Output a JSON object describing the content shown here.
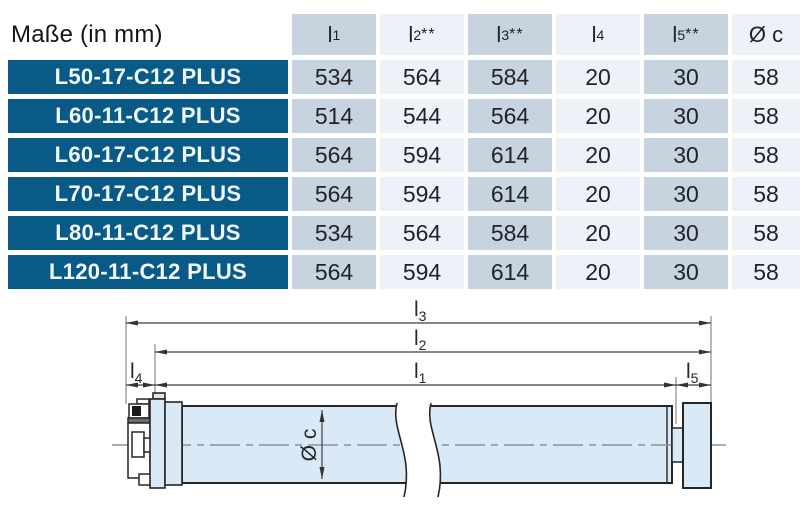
{
  "table": {
    "title": "Maße (in mm)",
    "headers": [
      {
        "base": "l",
        "sub": "1",
        "sup": ""
      },
      {
        "base": "l",
        "sub": "2",
        "sup": "**"
      },
      {
        "base": "l",
        "sub": "3",
        "sup": "**"
      },
      {
        "base": "l",
        "sub": "4",
        "sup": ""
      },
      {
        "base": "l",
        "sub": "5",
        "sup": "**"
      },
      {
        "base": "Ø c",
        "sub": "",
        "sup": ""
      }
    ],
    "rows": [
      {
        "model": "L50-17-C12 PLUS",
        "l1": "534",
        "l2": "564",
        "l3": "584",
        "l4": "20",
        "l5": "30",
        "dc": "58"
      },
      {
        "model": "L60-11-C12 PLUS",
        "l1": "514",
        "l2": "544",
        "l3": "564",
        "l4": "20",
        "l5": "30",
        "dc": "58"
      },
      {
        "model": "L60-17-C12 PLUS",
        "l1": "564",
        "l2": "594",
        "l3": "614",
        "l4": "20",
        "l5": "30",
        "dc": "58"
      },
      {
        "model": "L70-17-C12 PLUS",
        "l1": "564",
        "l2": "594",
        "l3": "614",
        "l4": "20",
        "l5": "30",
        "dc": "58"
      },
      {
        "model": "L80-11-C12 PLUS",
        "l1": "534",
        "l2": "564",
        "l3": "584",
        "l4": "20",
        "l5": "30",
        "dc": "58"
      },
      {
        "model": "L120-11-C12 PLUS",
        "l1": "564",
        "l2": "594",
        "l3": "614",
        "l4": "20",
        "l5": "30",
        "dc": "58"
      }
    ]
  },
  "diagram": {
    "dims": {
      "l1": {
        "base": "l",
        "sub": "1"
      },
      "l2": {
        "base": "l",
        "sub": "2"
      },
      "l3": {
        "base": "l",
        "sub": "3"
      },
      "l4": {
        "base": "l",
        "sub": "4"
      },
      "l5": {
        "base": "l",
        "sub": "5"
      },
      "diameter": {
        "base": "Ø c"
      }
    }
  },
  "colors": {
    "row_label_bg": "#0a5a87",
    "row_label_text": "#f2f9ff",
    "column_dark_bg": "#c8d3e0",
    "column_light_bg": "#eef2f8",
    "tube_fill": "#d9e9f6",
    "outline": "#262626",
    "dimension_line": "#3f3f3f",
    "extension_line": "#737373",
    "centerline": "#8494a0"
  }
}
